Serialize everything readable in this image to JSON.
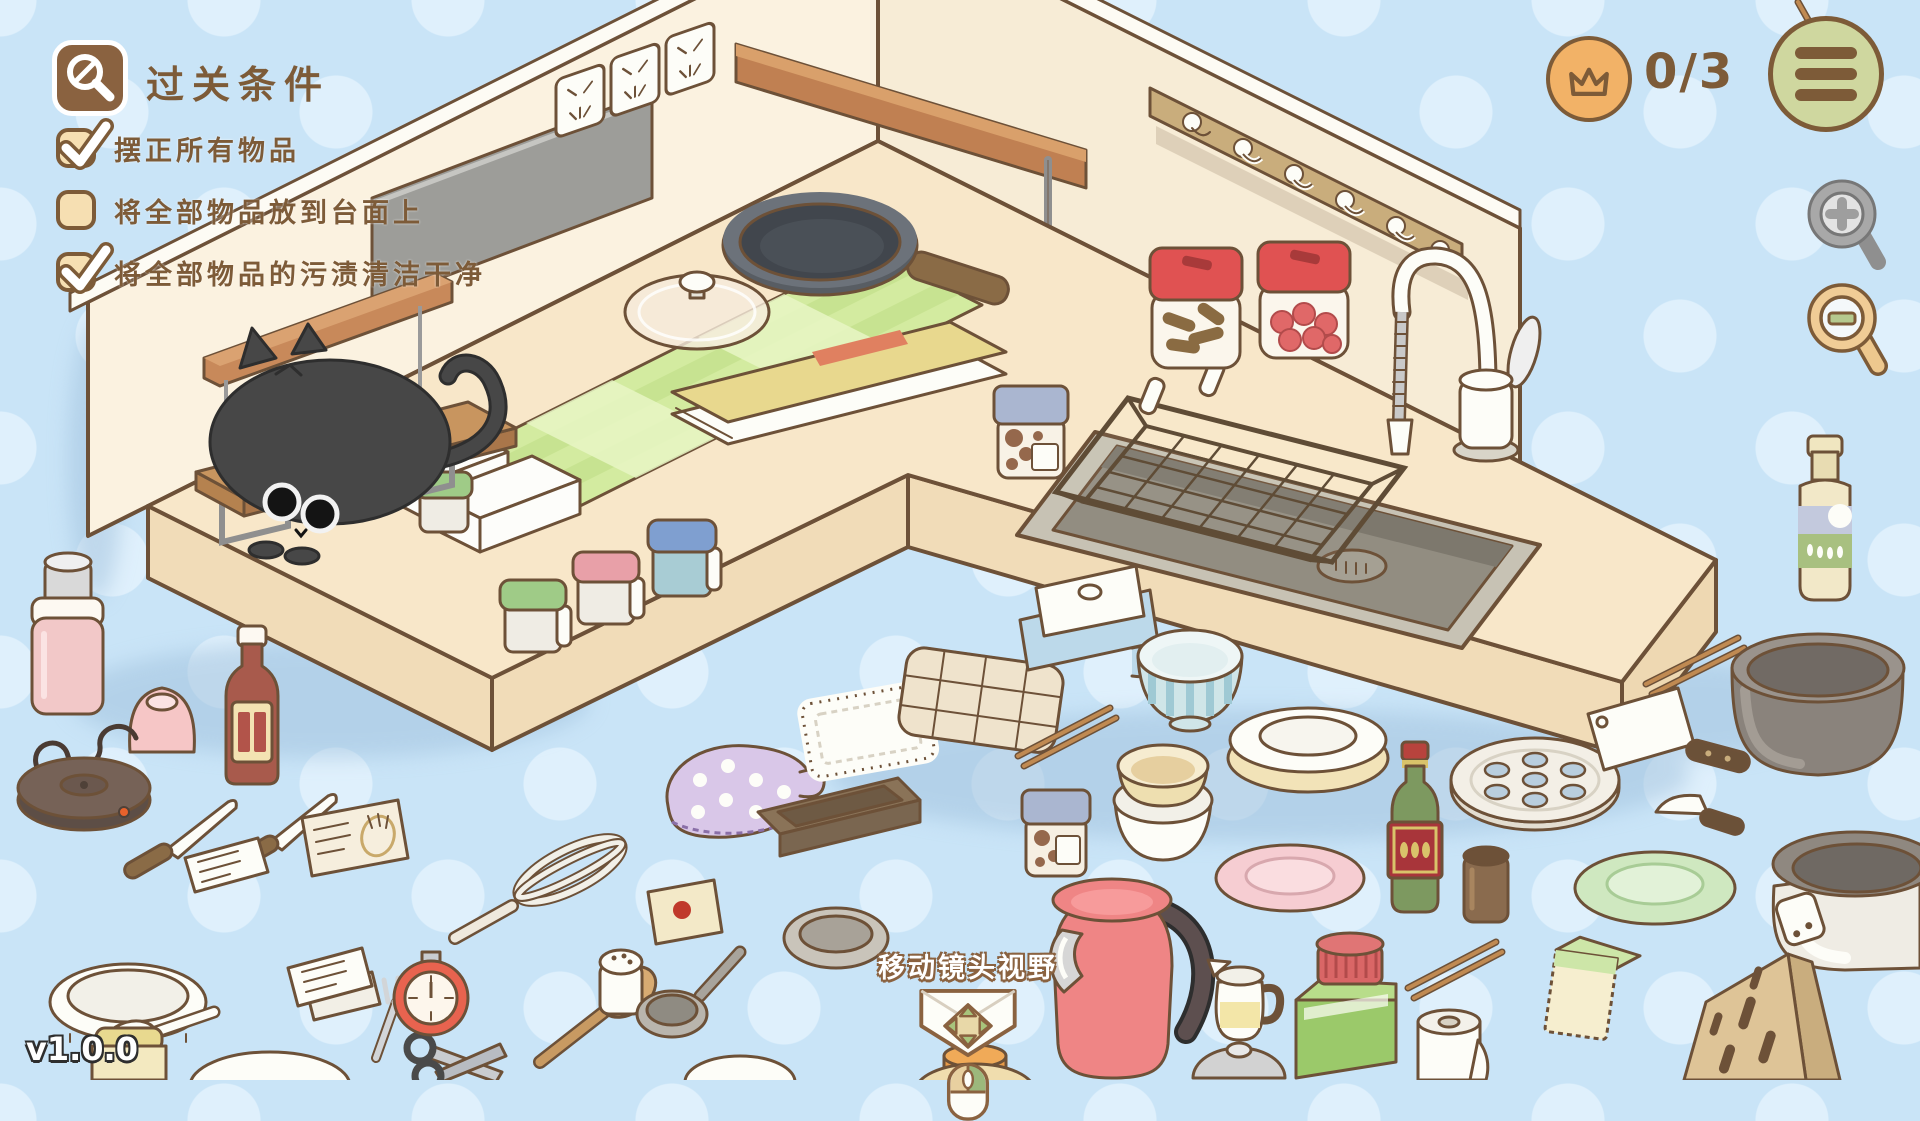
{
  "hud": {
    "goal_panel": {
      "icon": "inspect-magnifier-icon",
      "title": "过关条件",
      "conditions": [
        {
          "label": "摆正所有物品",
          "checked": true
        },
        {
          "label": "将全部物品放到台面上",
          "checked": false
        },
        {
          "label": "将全部物品的污渍清洁干净",
          "checked": true
        }
      ]
    },
    "score": {
      "icon": "crown-icon",
      "value": "0/3"
    },
    "menu": {
      "icon": "hamburger-icon"
    },
    "zoom_in": {
      "icon": "magnifier-plus-icon",
      "enabled": false
    },
    "zoom_out": {
      "icon": "magnifier-minus-icon",
      "enabled": true
    },
    "camera_hint": {
      "label": "移动镜头视野",
      "icons": [
        "move-arrows-icon",
        "mouse-drag-icon"
      ]
    },
    "version": "v1.0.0"
  },
  "colors": {
    "background": "#c9e4f7",
    "background_dots": "#dff0fc",
    "outline_brown": "#6d5138",
    "hud_brown": "#7d5b38",
    "checkbox_fill": "#f6dfb2",
    "crown_badge": "#f2b267",
    "menu_badge": "#cfd79f",
    "wall": "#fbf2e0",
    "counter_top": "#f8e7c9",
    "counter_face": "#f1dcb8",
    "mat_green": "#d3eba0",
    "cat_gray": "#474747",
    "kettle_pink": "#ef8585",
    "jar_lid_red": "#e05252"
  },
  "scene": {
    "room": [
      "left-wall",
      "right-wall",
      "l-shaped-counter",
      "sink-basin",
      "gooseneck-faucet",
      "wire-dish-basket",
      "power-outlets",
      "wall-wood-shelf",
      "wall-hook-rack",
      "gray-backsplash-panel"
    ],
    "counter_items": [
      "black-cat",
      "cat-wood-board-stand",
      "small-wood-shelf",
      "green-checkered-mat",
      "recipe-book",
      "glass-pot-lid",
      "frying-pan",
      "jam-jar",
      "spice-canister-green",
      "spice-canister-pink",
      "spice-canister-blue",
      "spice-canister-small",
      "white-riser-stand",
      "red-lid-jar-cinnamon",
      "red-lid-jar-berries"
    ],
    "scattered_items": [
      "pink-thermos",
      "pink-cup",
      "sauce-bottle",
      "electric-hot-plate",
      "kitchen-knife",
      "kitchen-knife-2",
      "note-card",
      "seed-packet",
      "white-oval-dish",
      "spoon",
      "yellow-jar",
      "white-plate-partial",
      "recipe-cards",
      "fork",
      "scissors",
      "kitchen-timer",
      "whisk",
      "wooden-spatula",
      "egg-card",
      "salt-shaker",
      "ladle",
      "oven-mitt",
      "lace-placemat",
      "baking-tray",
      "dish-towel",
      "butter-dish",
      "striped-bowl",
      "chopsticks-1",
      "chopsticks-2",
      "chopsticks-3",
      "plate-stack",
      "bowl-stack",
      "jam-jar-2",
      "pink-plate",
      "pink-kettle",
      "cream-pitcher",
      "wine-bottle",
      "brown-cup",
      "steamer-plate",
      "pickle-jar",
      "paper-towel-roll",
      "pot-lid-dome",
      "gray-pot",
      "rice-cooker",
      "cleaver",
      "paring-knife",
      "green-plate",
      "sponge",
      "knife-block",
      "dish-soap-bottle",
      "gray-bowl-partial",
      "orange-jar-partial",
      "white-bowl-partial",
      "yellow-bowl-partial"
    ]
  }
}
